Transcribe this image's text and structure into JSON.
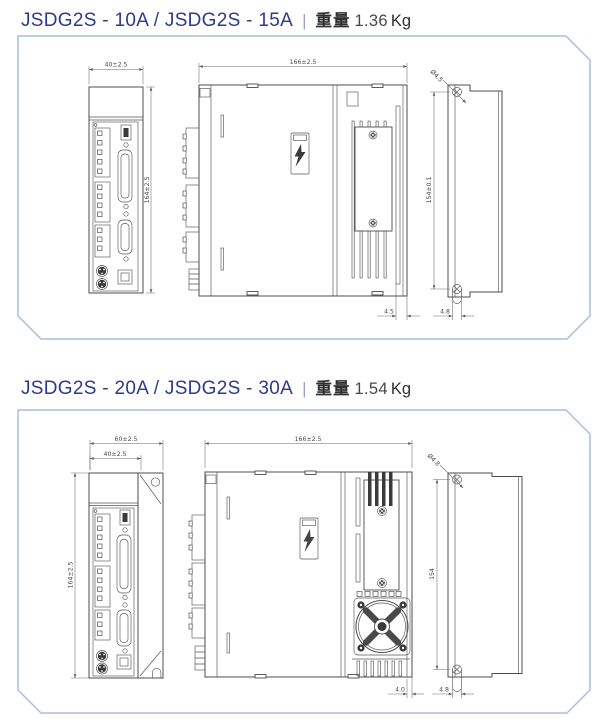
{
  "sections": [
    {
      "model": "JSDG2S - 10A / JSDG2S - 15A",
      "separator": "|",
      "weight_label": "重量",
      "weight_value": "1.36",
      "weight_unit": "Kg",
      "dims": {
        "front_width": "40±2.5",
        "front_height": "164±2.5",
        "side_depth": "166±2.5",
        "side_heatsink_gap": "4.5",
        "mount_hole_dia": "Ø4.5",
        "mount_pitch": "154±0.1",
        "mount_tab_width": "4.8"
      }
    },
    {
      "model": "JSDG2S - 20A / JSDG2S - 30A",
      "separator": "|",
      "weight_label": "重量",
      "weight_value": "1.54",
      "weight_unit": "Kg",
      "dims": {
        "front_outer_width": "60±2.5",
        "front_width": "40±2.5",
        "front_height": "164±2.5",
        "side_depth": "166±2.5",
        "side_heatsink_gap": "4.0",
        "mount_hole_dia": "Ø4.8",
        "mount_pitch": "154",
        "mount_tab_width": "4.8"
      }
    }
  ],
  "colors": {
    "title_accent": "#2e3a8d",
    "panel_border": "#aabdda",
    "drawing_line": "#4c4c4c",
    "dimension_line": "#6b6b6b"
  }
}
